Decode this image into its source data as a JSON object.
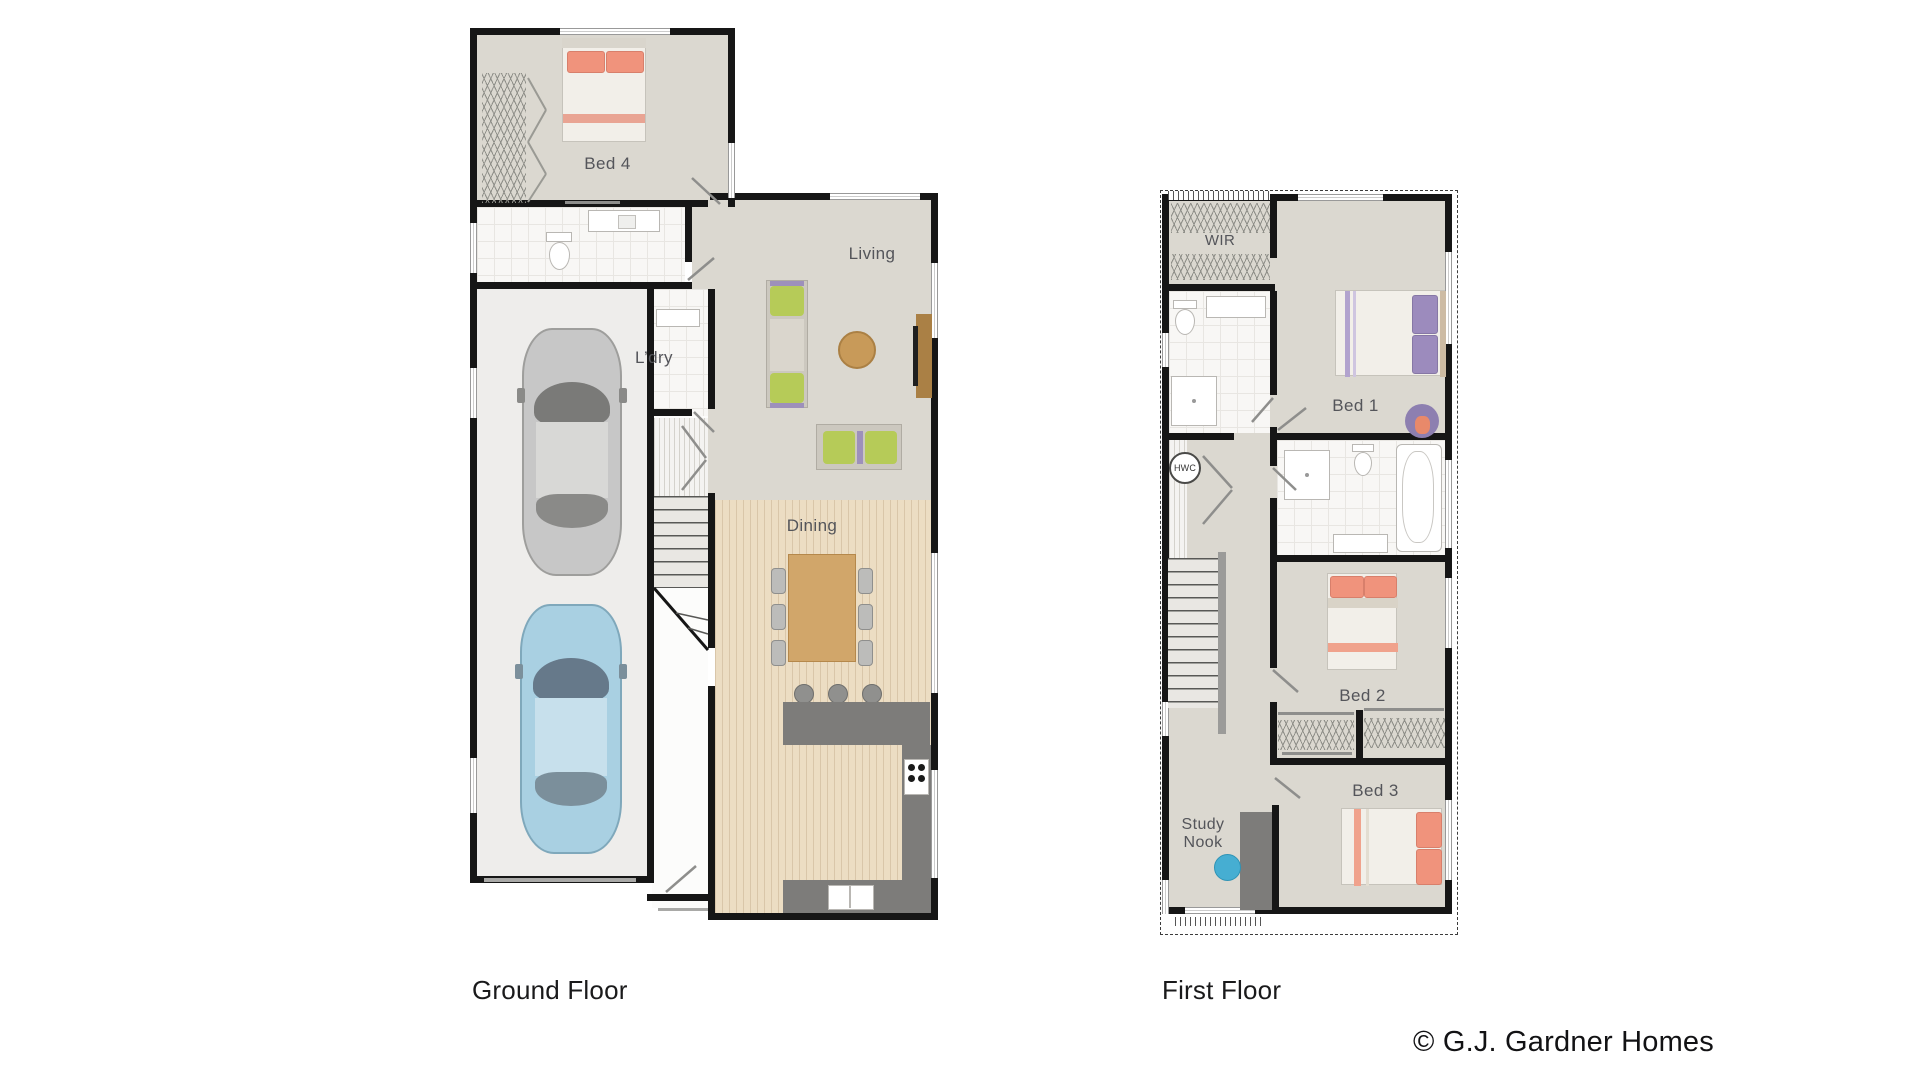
{
  "ground_floor": {
    "title": "Ground Floor",
    "labels": {
      "bed4": "Bed 4",
      "laundry": "L’dry",
      "living": "Living",
      "dining": "Dining"
    }
  },
  "first_floor": {
    "title": "First Floor",
    "labels": {
      "wir": "WIR",
      "hwc": "HWC",
      "bed1": "Bed 1",
      "bed2": "Bed 2",
      "bed3": "Bed 3",
      "study_nook": "Study Nook"
    }
  },
  "footer": {
    "copyright": "© G.J. Gardner Homes"
  },
  "colors": {
    "wall": "#161616",
    "room_carpet": "#dbd8d0",
    "tile_floor": "#f8f7f5",
    "garage_floor": "#eeedeb",
    "timber_floor": "#ecddc3",
    "kitchen_counter": "#7d7c7a",
    "bed_salmon": "#f0937c",
    "bed_purple": "#9c8bbd",
    "sofa_green": "#b6cb58",
    "study_chair_blue": "#46aed2",
    "car_silver": "#c7c7c7",
    "car_blue": "#a9d0e2",
    "dining_table_wood": "#d1a66a",
    "label_gray": "#54555a"
  }
}
